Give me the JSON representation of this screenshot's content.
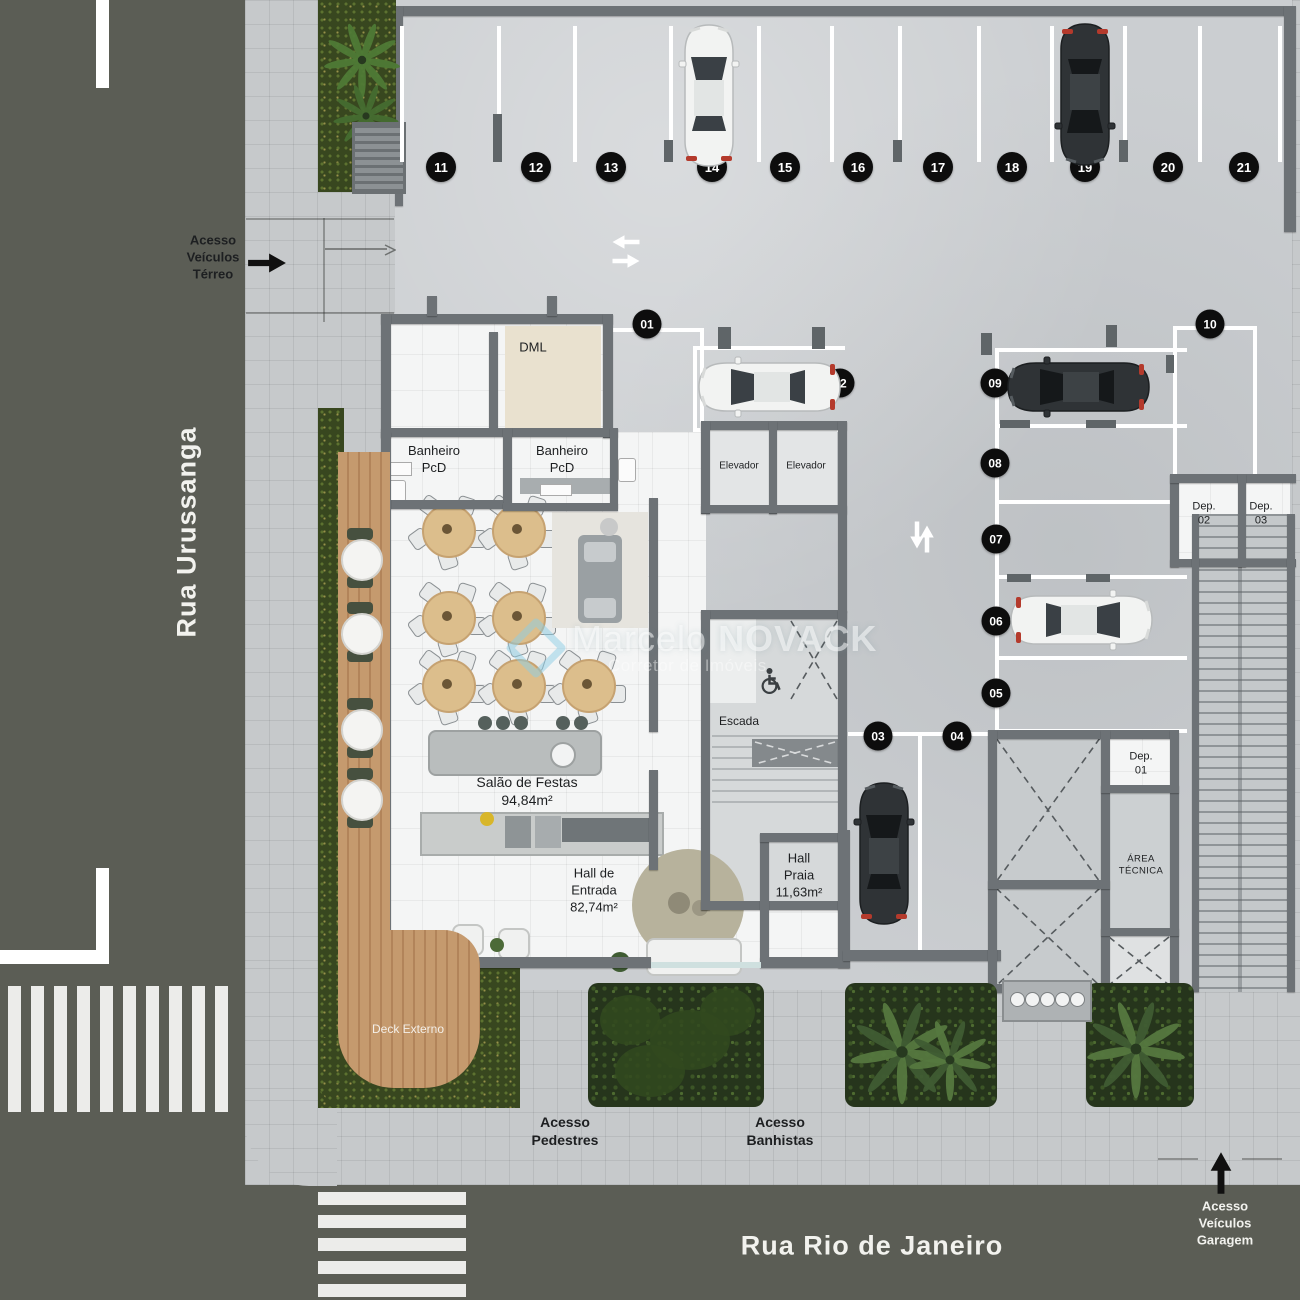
{
  "streets": {
    "left": "Rua Urussanga",
    "bottom": "Rua Rio de Janeiro"
  },
  "access": {
    "terreo": [
      "Acesso",
      "Veículos",
      "Térreo"
    ],
    "pedestres": [
      "Acesso",
      "Pedestres"
    ],
    "banhistas": [
      "Acesso",
      "Banhistas"
    ],
    "garagem": [
      "Acesso",
      "Veículos",
      "Garagem"
    ]
  },
  "rooms": {
    "dml": "DML",
    "banheiro_pcd_1": [
      "Banheiro",
      "PcD"
    ],
    "banheiro_pcd_2": [
      "Banheiro",
      "PcD"
    ],
    "elevador_1": "Elevador",
    "elevador_2": "Elevador",
    "escada": "Escada",
    "salao_festas": [
      "Salão de Festas",
      "94,84m²"
    ],
    "hall_entrada": [
      "Hall de",
      "Entrada",
      "82,74m²"
    ],
    "hall_praia": [
      "Hall",
      "Praia",
      "11,63m²"
    ],
    "dep_01": [
      "Dep.",
      "01"
    ],
    "dep_02": [
      "Dep.",
      "02"
    ],
    "dep_03": [
      "Dep.",
      "03"
    ],
    "area_tecnica": [
      "ÁREA",
      "TÉCNICA"
    ],
    "deck_externo": "Deck Externo"
  },
  "parking": {
    "top_row": [
      "11",
      "12",
      "13",
      "14",
      "15",
      "16",
      "17",
      "18",
      "19",
      "20",
      "21"
    ],
    "inner": [
      "01",
      "02",
      "03",
      "04",
      "05",
      "06",
      "07",
      "08",
      "09",
      "10"
    ],
    "occupied": [
      {
        "spot": "14",
        "car": "white"
      },
      {
        "spot": "19",
        "car": "dark"
      },
      {
        "spot": "02",
        "car": "white"
      },
      {
        "spot": "09",
        "car": "dark"
      },
      {
        "spot": "06",
        "car": "white"
      },
      {
        "spot": "03",
        "car": "dark"
      }
    ]
  },
  "watermark": {
    "name_light": "Marcelo",
    "name_bold": "NOVACK",
    "subtitle": "Corretor de Imóveis"
  },
  "colors": {
    "street": "#5b5d55",
    "sidewalk": "#c6c9cb",
    "slab": "#cbced1",
    "wall": "#6d7276",
    "interior": "#f4f5f5",
    "deck": "#c1946a",
    "hedge": "#38471f",
    "badge": "#0d0d0d",
    "stripe": "#ececea",
    "table": "#dcbe8c",
    "car_white": "#f2f3f2",
    "car_dark": "#2f3336",
    "taillight": "#b43a2c"
  }
}
